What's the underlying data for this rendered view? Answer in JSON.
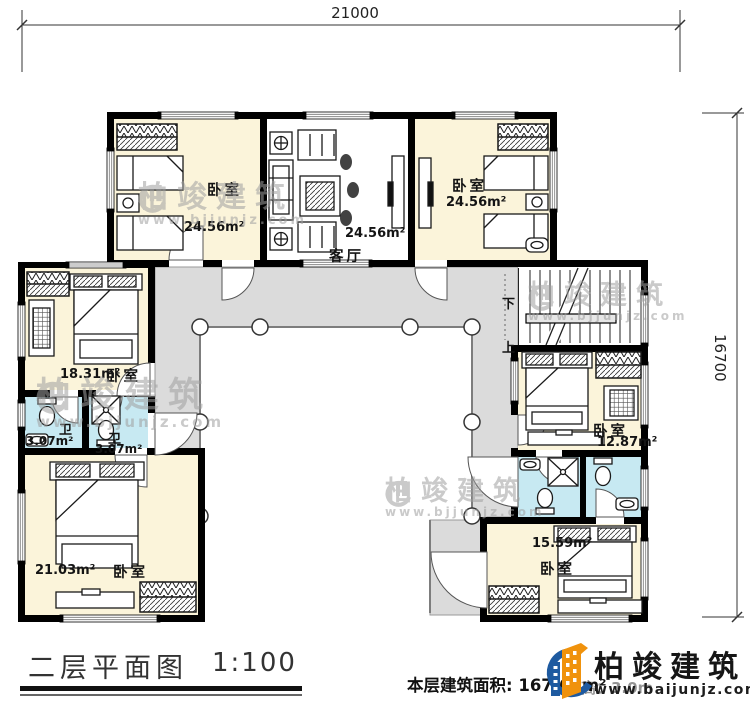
{
  "dimensions": {
    "top": "21000",
    "right": "16700"
  },
  "rooms": {
    "bedroom_top_left": {
      "label": "卧室",
      "area": "24.56m²"
    },
    "living_room": {
      "label": "客厅",
      "area": "24.56m²"
    },
    "bedroom_top_right": {
      "label": "卧室",
      "area": "24.56m²"
    },
    "bedroom_mid_left": {
      "label": "卧室",
      "area": "18.31m²"
    },
    "bath_left_a": {
      "label": "卫",
      "area": "3.07m²"
    },
    "bath_left_b": {
      "label": "卫",
      "area": "3.07m²"
    },
    "bedroom_bottom_left": {
      "label": "卧室",
      "area": "21.03m²"
    },
    "bedroom_mid_right": {
      "label": "卧室",
      "area": "12.87m²"
    },
    "bedroom_bottom_right": {
      "label": "卧室",
      "area": "15.59m²"
    }
  },
  "stairs": {
    "down": "下",
    "up": "上"
  },
  "watermark": {
    "brand": "柏竣建筑",
    "url": "www.bjjunjz.com"
  },
  "footer": {
    "title": "二层平面图",
    "scale": "1:100",
    "area_text": "本层建筑面积: 167.61m²",
    "floor_height_text": "层高：3.0m"
  },
  "logo": {
    "brand": "柏竣建筑",
    "url": "www.baijunjz.com"
  },
  "colors": {
    "room_fill": "#FBF4DA",
    "bath_fill": "#C7E9F2",
    "terrace_fill": "#DBDBDB",
    "wall": "#000000",
    "logo_blue": "#1E5AA0",
    "logo_orange": "#F0920C"
  }
}
